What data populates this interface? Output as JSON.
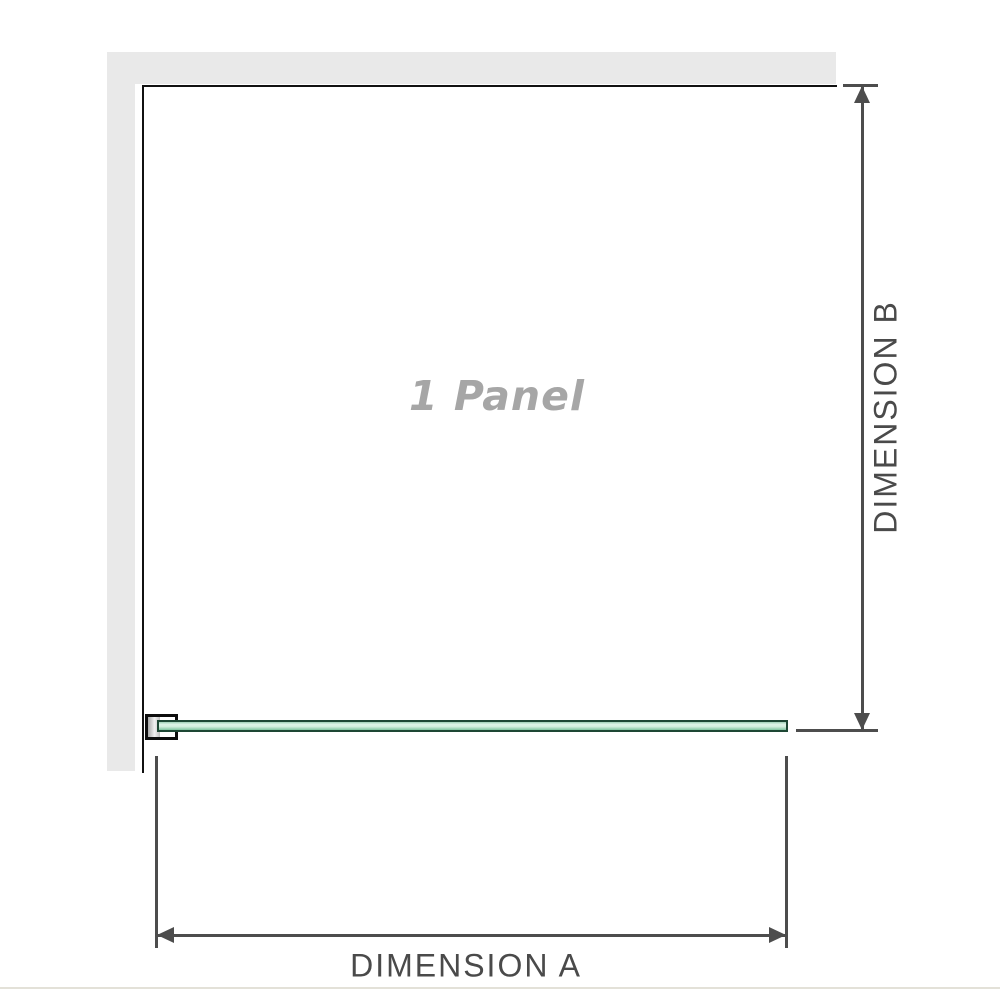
{
  "diagram": {
    "panel_label": "1 Panel",
    "dimensions": {
      "a_label": "DIMENSION A",
      "b_label": "DIMENSION B"
    },
    "colors": {
      "wall": "#e9e9e9",
      "panel_outline": "#111111",
      "dimension_line": "#4d4d4d",
      "dimension_text": "#4a4a4a",
      "panel_label_text": "#a6a6a6",
      "glass_border": "#1d4734",
      "glass_fill_light": "#def4e8",
      "glass_fill_mid": "#8bcda9",
      "bracket_outline": "#0d0d0d",
      "bracket_anchor": "#c9c9c9",
      "baseline": "#e3e1d8",
      "background": "#ffffff"
    }
  }
}
